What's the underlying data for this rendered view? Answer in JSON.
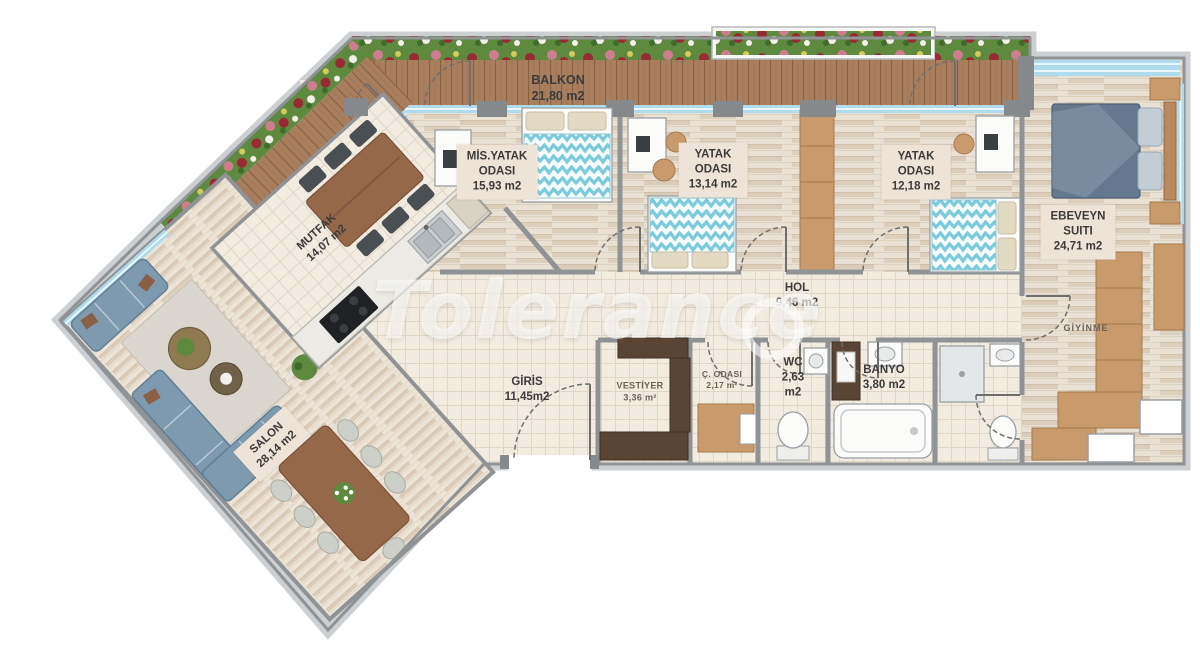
{
  "watermark": {
    "text": "Tolerance"
  },
  "rooms": {
    "balkon": {
      "name": "BALKON",
      "area": "21,80 m2"
    },
    "mis_yatak": {
      "line1": "MİS.YATAK",
      "line2": "ODASI",
      "area": "15,93 m2"
    },
    "yatak1": {
      "line1": "YATAK",
      "line2": "ODASI",
      "area": "13,14 m2"
    },
    "yatak2": {
      "line1": "YATAK",
      "line2": "ODASI",
      "area": "12,18 m2"
    },
    "ebeveyn": {
      "line1": "EBEVEYN",
      "line2": "SUITI",
      "area": "24,71 m2"
    },
    "mutfak": {
      "name": "MUTFAK",
      "area": "14,07 m2"
    },
    "hol": {
      "name": "HOL",
      "area": "9,46 m2"
    },
    "giris": {
      "name": "GİRİS",
      "area": "11,45m2"
    },
    "vestiyer": {
      "name": "VESTİYER",
      "area": "3,36 m²"
    },
    "c_odasi": {
      "name": "Ç. ODASI",
      "area": "2,17 m²"
    },
    "wc": {
      "name": "WC",
      "area1": "2,63",
      "area2": "m2"
    },
    "banyo": {
      "name": "BANYO",
      "area": "3,80 m2"
    },
    "giyinme": {
      "name": "GİYİNME"
    },
    "salon": {
      "name": "SALON",
      "area": "28,14 m2"
    }
  },
  "palette": {
    "wall": "#8f9396",
    "band": "#cdd0d2",
    "tile": "#f1ebe0",
    "wood": "#e9e1d3",
    "deck": "#a87e5d",
    "window": "#aedcee",
    "labelbox": "#eee3d7",
    "ink": "#3b3b3b",
    "muted": "#6b6257",
    "sofa": "#7e9aaf",
    "woodfurn": "#96684a",
    "tan": "#c99a6c",
    "darkwood": "#5a4434",
    "chevron": "#7ccade",
    "masterbed": "#64798e",
    "green": "#5d8a3f"
  }
}
